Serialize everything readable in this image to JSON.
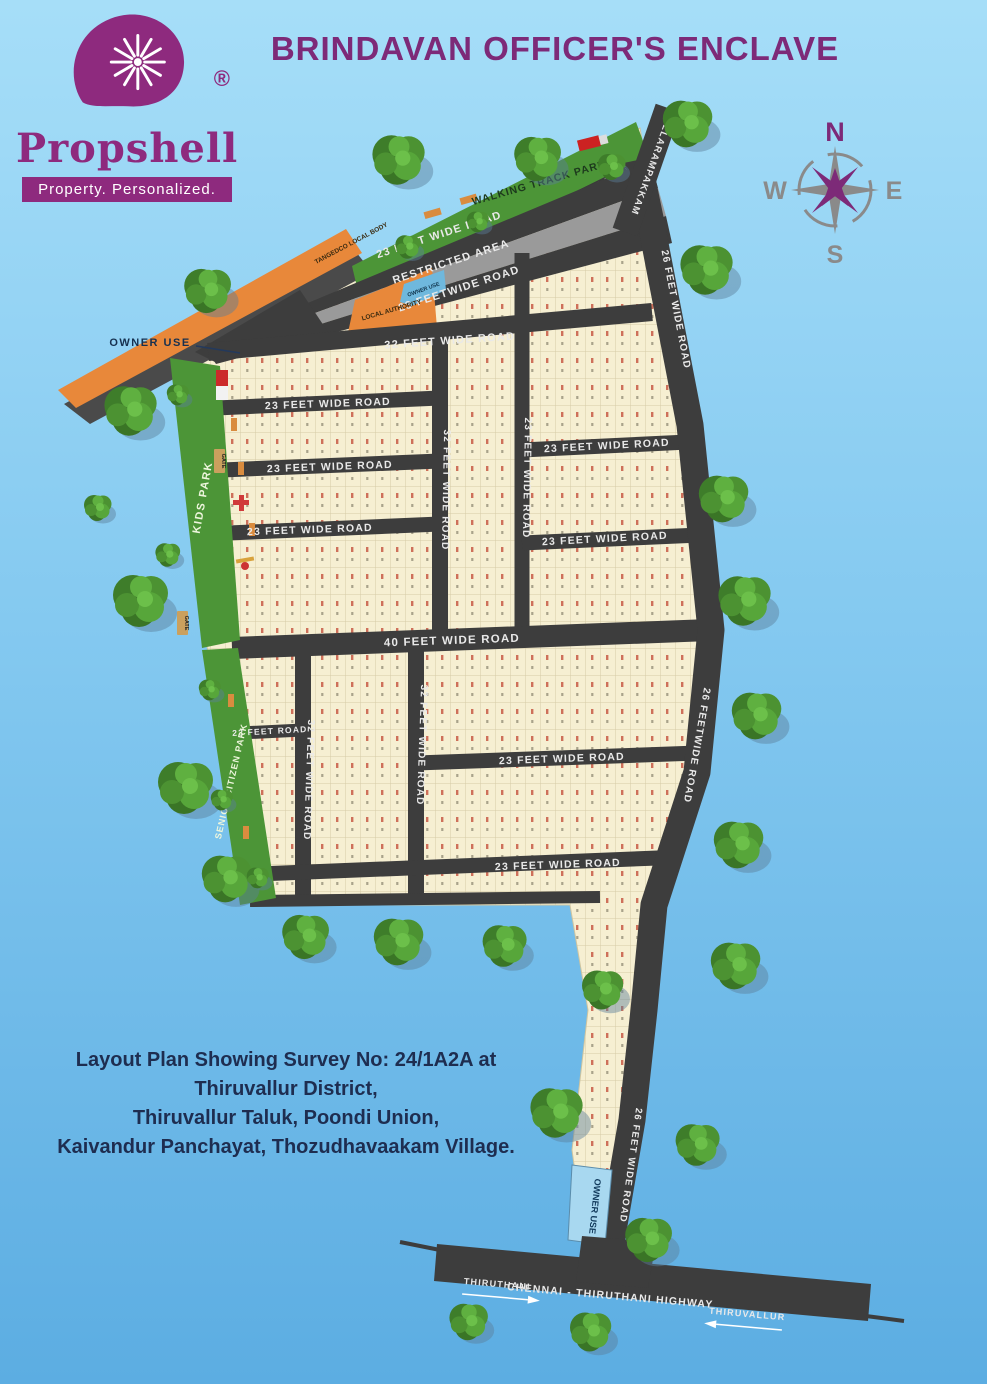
{
  "header": {
    "logo": {
      "brand": "Propshell",
      "registered": "®",
      "tagline": "Property. Personalized."
    },
    "title": "BRINDAVAN OFFICER'S ENCLAVE",
    "compass": {
      "n": "N",
      "e": "E",
      "s": "S",
      "w": "W"
    }
  },
  "map": {
    "labels": {
      "owner_use_pointer": "OWNER USE",
      "owner_use_top_plot": "OWNER USE",
      "owner_use_bottom_plot": "OWNER USE",
      "gate": "GATE",
      "restricted": "RESTRICTED AREA",
      "tangedco": "TANGEDCO LOCAL BODY",
      "local_authority": "LOCAL AUTHORITY"
    },
    "parks": {
      "walking_track": "WALKING TRACK PARK",
      "kids": "KIDS PARK",
      "senior_citizen": "SENIOR CITIZEN PARK"
    },
    "roads": {
      "pallarampakkam": "PALLARAMPAKKAM",
      "feet23": "23 FEET WIDE ROAD",
      "feet23_nospace": "23 FEETWIDE ROAD",
      "feet23_short": "23 FEET ROAD",
      "feet26": "26 FEET WIDE ROAD",
      "feet26_nospace": "26 FEETWIDE ROAD",
      "feet32": "32 FEET WIDE ROAD",
      "feet40": "40 FEET WIDE ROAD"
    },
    "highway": {
      "name": "CHENNAI - THIRUTHANI HIGHWAY",
      "toward_left": "THIRUTHANI",
      "toward_right": "THIRUVALLUR"
    },
    "plot_annotations": {
      "number_color": "#c0392b",
      "sample_plot_numbers": [
        "232",
        "233",
        "234",
        "236",
        "237",
        "238",
        "240",
        "241",
        "243",
        "244",
        "245",
        "247",
        "248"
      ],
      "sample_dimensions": [
        "16.04",
        "18.04",
        "21.01",
        "23.03",
        "28.03",
        "34.07",
        "38.08",
        "40.09",
        "41.10",
        "42.08",
        "44.09",
        "45.02",
        "45.04",
        "46.03",
        "47.08",
        "47.30",
        "48.30",
        "52.08",
        "56.04",
        "57.08",
        "64.08",
        "67.08",
        "69.08",
        "70.01",
        "70.02",
        "71.01",
        "73.04"
      ]
    }
  },
  "footer": {
    "line1": "Layout Plan Showing Survey No: 24/1A2A at Thiruvallur District,",
    "line2": "Thiruvallur Taluk, Poondi Union,",
    "line3": "Kaivandur Panchayat, Thozudhavaakam Village."
  },
  "colors": {
    "brand_purple": "#8e2a7e",
    "title_purple": "#7d2a78",
    "road_dark": "#3d3d3d",
    "restricted_gray": "#9a9a9a",
    "plot_cream": "#f6efd2",
    "park_green": "#4c9537",
    "orange_area": "#e8883a",
    "sky_top": "#a6def8",
    "sky_bottom": "#5cade2",
    "footer_navy": "#1e2d50"
  }
}
